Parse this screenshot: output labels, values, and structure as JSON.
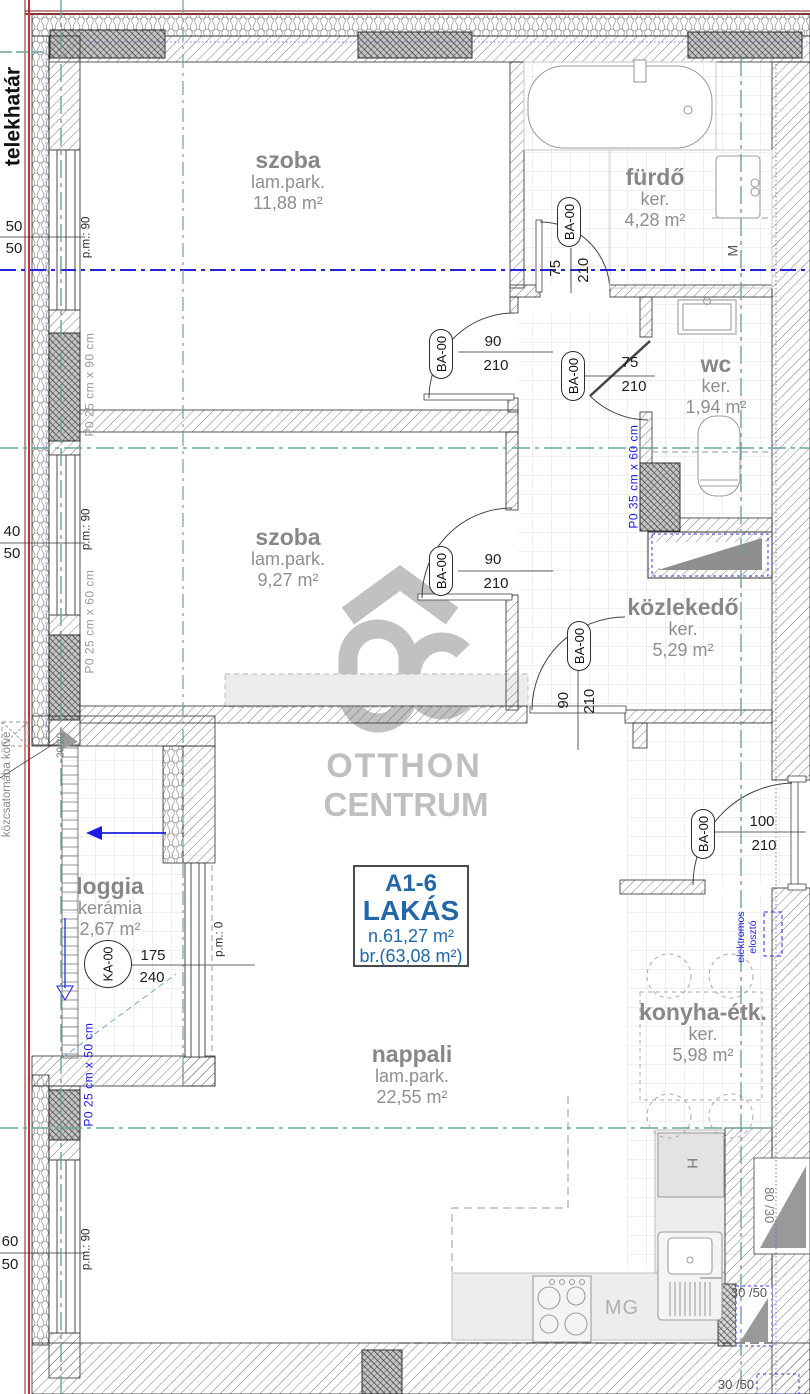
{
  "plan": {
    "property_line_label": "telekhatár",
    "apartment": {
      "code": "A1-6",
      "type": "LAKÁS",
      "net_area": "n.61,27 m²",
      "gross_area": "br.(63,08 m²)"
    },
    "rooms": [
      {
        "name": "szoba",
        "finish": "lam.park.",
        "area": "11,88 m²"
      },
      {
        "name": "fürdő",
        "finish": "ker.",
        "area": "4,28 m²"
      },
      {
        "name": "wc",
        "finish": "ker.",
        "area": "1,94 m²"
      },
      {
        "name": "szoba",
        "finish": "lam.park.",
        "area": "9,27 m²"
      },
      {
        "name": "közlekedő",
        "finish": "ker.",
        "area": "5,29 m²"
      },
      {
        "name": "loggia",
        "finish": "kerámia",
        "area": "2,67 m²"
      },
      {
        "name": "nappali",
        "finish": "lam.park.",
        "area": "22,55 m²"
      },
      {
        "name": "konyha-étk.",
        "finish": "ker.",
        "area": "5,98 m²"
      }
    ],
    "doors": [
      {
        "label": "BA-00",
        "width": "75",
        "height": "210"
      },
      {
        "label": "BA-00",
        "width": "90",
        "height": "210"
      },
      {
        "label": "BA-00",
        "width": "75",
        "height": "210"
      },
      {
        "label": "BA-00",
        "width": "90",
        "height": "210"
      },
      {
        "label": "BA-00",
        "width": "90",
        "height": "210"
      },
      {
        "label": "BA-00",
        "width": "100",
        "height": "210"
      },
      {
        "label": "KA-00",
        "width": "175",
        "height": "240"
      }
    ],
    "windows": [
      {
        "dim_top": "50",
        "dim_bottom": "50",
        "parapet": "p.m.: 90"
      },
      {
        "dim_top": "40",
        "dim_bottom": "50",
        "parapet": "p.m.: 90"
      },
      {
        "dim_top": "60",
        "dim_bottom": "50",
        "parapet": "p.m.: 90"
      }
    ],
    "loggia_door_parapet": "p.m.: 0",
    "pillar_labels": [
      "P0  25 cm x 90 cm",
      "P0  25 cm x 60 cm",
      "P0  35 cm x 60 cm",
      "P0  25 cm x 50 cm"
    ],
    "annotations": {
      "sewer": "közcsatornába kötve",
      "spout_dim": "20/20",
      "electrical": "elektromos elosztó",
      "washing_machine": "M",
      "dishwasher": "MG",
      "fridge": "H",
      "shaft_a": "80 /30",
      "shaft_b": "30 /50",
      "shaft_c": "30 /50"
    },
    "watermark": {
      "line1": "OTTHON",
      "line2": "CENTRUM"
    }
  }
}
